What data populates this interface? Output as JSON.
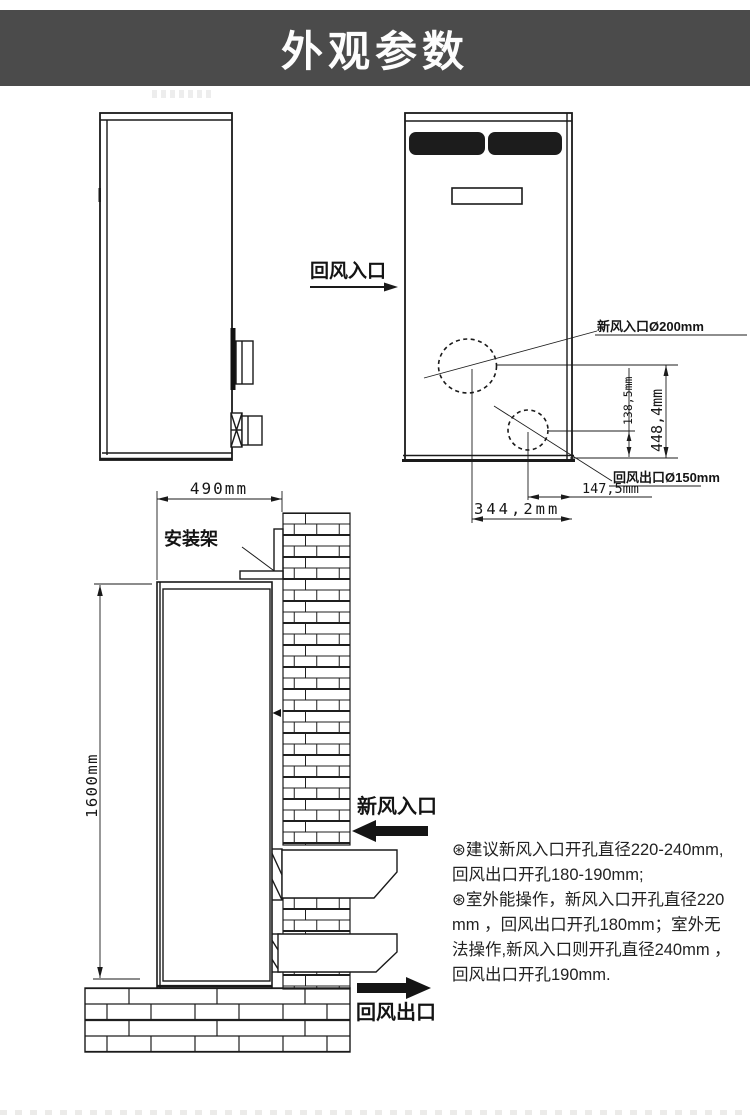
{
  "title": "外观参数",
  "colors": {
    "header_bg": "#4b4b4b",
    "header_text": "#fdfdfd",
    "line": "#1a1a1a",
    "grille_fill": "#1c1c1c",
    "notes_text": "#222222"
  },
  "side_view": {
    "return_air_inlet_label": "回风入口"
  },
  "front_view": {
    "fresh_air_hole_label": "新风入口Ø200mm",
    "return_air_hole_label": "回风出口Ø150mm",
    "dim_vertical_small": "138,5mm",
    "dim_vertical_large": "448,4mm",
    "dim_horizontal_small": "147,5mm",
    "dim_horizontal_large": "344,2mm"
  },
  "install_view": {
    "width_dim": "490mm",
    "height_dim": "1600mm",
    "bracket_label": "安装架",
    "fresh_air_inlet_label": "新风入口",
    "return_air_outlet_label": "回风出口"
  },
  "notes": {
    "lines": [
      "⊛建议新风入口开孔直径220-240mm,",
      "回风出口开孔180-190mm;",
      "⊛室外能操作，新风入口开孔直径220",
      "mm ，回风出口开孔180mm；室外无",
      "法操作,新风入口则开孔直径240mm ，",
      "回风出口开孔190mm."
    ]
  }
}
